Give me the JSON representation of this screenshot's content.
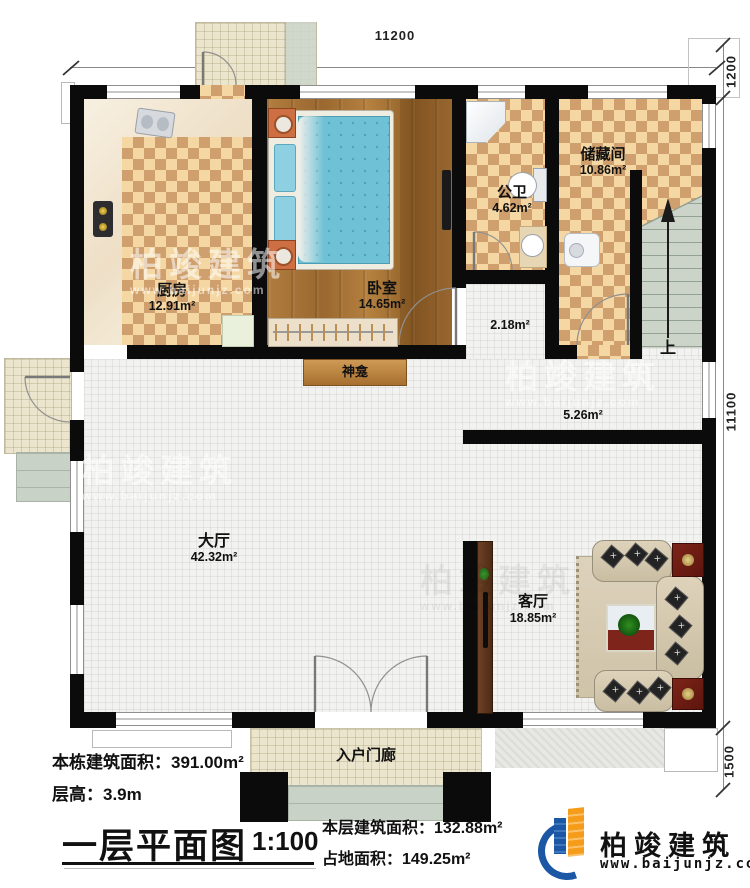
{
  "dimensions": {
    "top": "11200",
    "right_top": "1200",
    "right_middle": "11100",
    "right_bottom": "1500"
  },
  "rooms": {
    "kitchen": {
      "name": "厨房",
      "area": "12.91m²"
    },
    "bedroom": {
      "name": "卧室",
      "area": "14.65m²"
    },
    "bathroom": {
      "name": "公卫",
      "area": "4.62m²"
    },
    "storage": {
      "name": "储藏间",
      "area": "10.86m²"
    },
    "hall": {
      "name": "大厅",
      "area": "42.32m²"
    },
    "living_room": {
      "name": "客厅",
      "area": "18.85m²"
    },
    "entry_porch": {
      "name": "入户门廊"
    },
    "shrine": {
      "name": "神龛"
    },
    "hallway": {
      "area": "2.18m²"
    },
    "corridor": {
      "area": "5.26m²"
    },
    "stairs": {
      "up_label": "上"
    }
  },
  "footer": {
    "building_area": "本栋建筑面积：391.00m²",
    "floor_height": "层高：3.9m",
    "plan_title": "一层平面图",
    "scale": "1:100",
    "floor_area": "本层建筑面积：132.88m²",
    "footprint_area": "占地面积：149.25m²"
  },
  "logo": {
    "company": "柏竣建筑",
    "website": "www.baijunjz.com"
  },
  "watermark": {
    "text": "柏竣建筑",
    "subtext": "www.baijunjz.com"
  }
}
